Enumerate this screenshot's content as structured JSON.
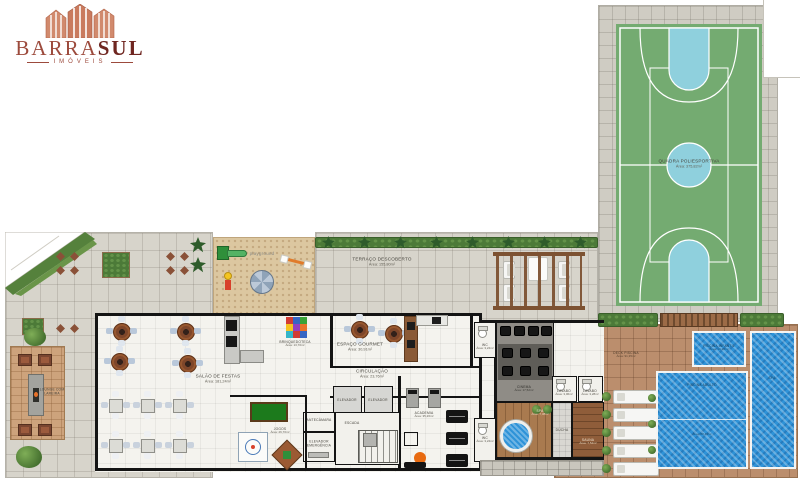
{
  "logo": {
    "brand_primary": "BARRA",
    "brand_secondary": "SUL",
    "subtitle": "IMÓVEIS"
  },
  "colors": {
    "brand_maroon": "#6f2620",
    "brand_salmon": "#d18a6d",
    "court_green": "#74ab71",
    "court_blue": "#8fd0dd",
    "pool_blue": "#2f93d8",
    "deck_brown": "#bb8e6d"
  },
  "labels": {
    "quadra": {
      "title": "QUADRA POLIESPORTIVA",
      "area": "Área: 375,82m²"
    },
    "terraco": {
      "title": "TERRAÇO DESCOBERTO",
      "area": "Área: 155,80m²"
    },
    "playground": {
      "title": "playground"
    },
    "salao": {
      "title": "SALÃO DE FESTAS",
      "area": "Área: 181,24m²"
    },
    "brinquedoteca": {
      "title": "BRINQUEDOTECA",
      "area": "Área: 13,70m²"
    },
    "gourmet": {
      "title": "ESPAÇO GOURMET",
      "area": "Área: 30,91m²"
    },
    "circulacao": {
      "title": "CIRCULAÇÃO",
      "area": "Área: 23,76m²"
    },
    "elevador": {
      "title": "ELEVADOR"
    },
    "antecamara": {
      "title": "ANTECÂMARA"
    },
    "escada": {
      "title": "ESCADA"
    },
    "elevador_emergencia": {
      "title": "ELEVADOR EMERGÊNCIA"
    },
    "jogos": {
      "title": "JOGOS",
      "area": "Área: 26,70m²"
    },
    "academia": {
      "title": "ACADEMIA",
      "area": "Área: 35,26m²"
    },
    "wc_superior": {
      "title": "WC",
      "area": "Área: 3,24m²"
    },
    "wc_inferior": {
      "title": "WC",
      "area": "Área: 3,24m²"
    },
    "cinema": {
      "title": "CINEMA",
      "area": "Área: 17,52m²"
    },
    "lavabo_1": {
      "title": "LAVABO",
      "area": "Área: 3,06m²"
    },
    "lavabo_2": {
      "title": "LAVABO",
      "area": "Área: 3,28m²"
    },
    "spa": {
      "title": "SPA",
      "area": "Área: 7,38m²"
    },
    "ducha": {
      "title": "DUCHA"
    },
    "sauna": {
      "title": "SAUNA",
      "area": "Área: 7,54m²"
    },
    "deck_piscina": {
      "title": "DECK PISCINA",
      "area": "Área: 91,35m²"
    },
    "piscina_adulto": {
      "title": "PISCINA ADULTO",
      "area": "Área: 58,43m²"
    },
    "piscina_infantil": {
      "title": "PISCINA INFANTIL",
      "area": "Área: 10,20m²"
    },
    "piscina_spa": {
      "title": "SPA"
    },
    "lounge": {
      "title": "LOUNGE COM LAREIRA"
    }
  }
}
